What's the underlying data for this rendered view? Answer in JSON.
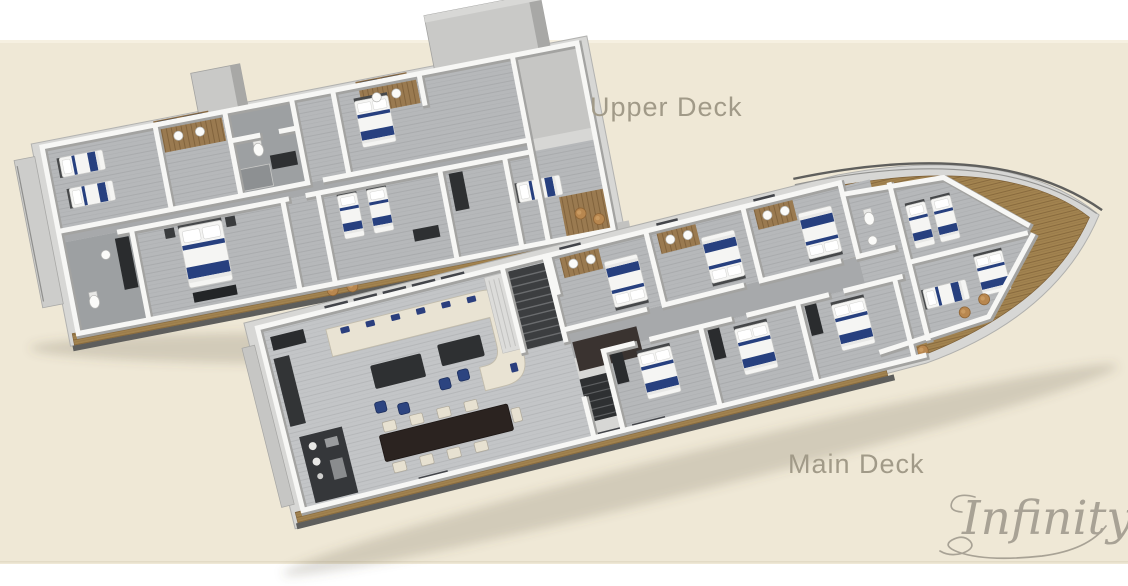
{
  "window": {
    "width": 1128,
    "height": 586
  },
  "panel": {
    "background": "#efe8d6",
    "top_margin_color": "#ffffff",
    "bottom_margin_color": "#ffffff",
    "edge_highlight": "#f6f0e1",
    "edge_line": "#e3dbc6"
  },
  "labels": {
    "upper_deck": "Upper Deck",
    "main_deck": "Main Deck",
    "color": "#a19a88"
  },
  "signature": {
    "text": "Infinity",
    "color": "#a8a295"
  },
  "decks": [
    {
      "name": "Upper Deck",
      "features": [
        "master-cabin-double-bed",
        "twin-cabin-two-beds",
        "vip-cabin-double-bed",
        "twin-guest-cabin",
        "aft-single-cabin",
        "bathrooms-wood-floor",
        "side-teak-walkway",
        "superstructure-blocks",
        "deck-stools"
      ]
    },
    {
      "name": "Main Deck",
      "features": [
        "salon-u-shaped-cream-sofa",
        "blue-cushions",
        "coffee-tables",
        "dining-table-eight-chairs",
        "galley-counter",
        "staircase",
        "three-double-guest-cabins-top",
        "three-double-guest-cabins-bottom",
        "bow-twin-cabin",
        "teak-bow-deck",
        "bow-rail",
        "deck-stools"
      ]
    }
  ],
  "palette": {
    "cabin_floor": "#b6b8ba",
    "salon_floor": "#c3c5c7",
    "corridor": "#a7a9ab",
    "walls": "#f7f7f5",
    "wall_shadow": "#a3a3a1",
    "teak_deck": "#a2834f",
    "bath_wood": "#9a7a50",
    "bed_linen": "#f5f5f3",
    "bed_navy": "#27407f",
    "sofa_cream": "#e9e3d3",
    "furniture_dark": "#2e3032",
    "superstructure": "#c9c9c7",
    "hull_dark": "#5e5e5c",
    "stool_tan": "#b8874f"
  }
}
